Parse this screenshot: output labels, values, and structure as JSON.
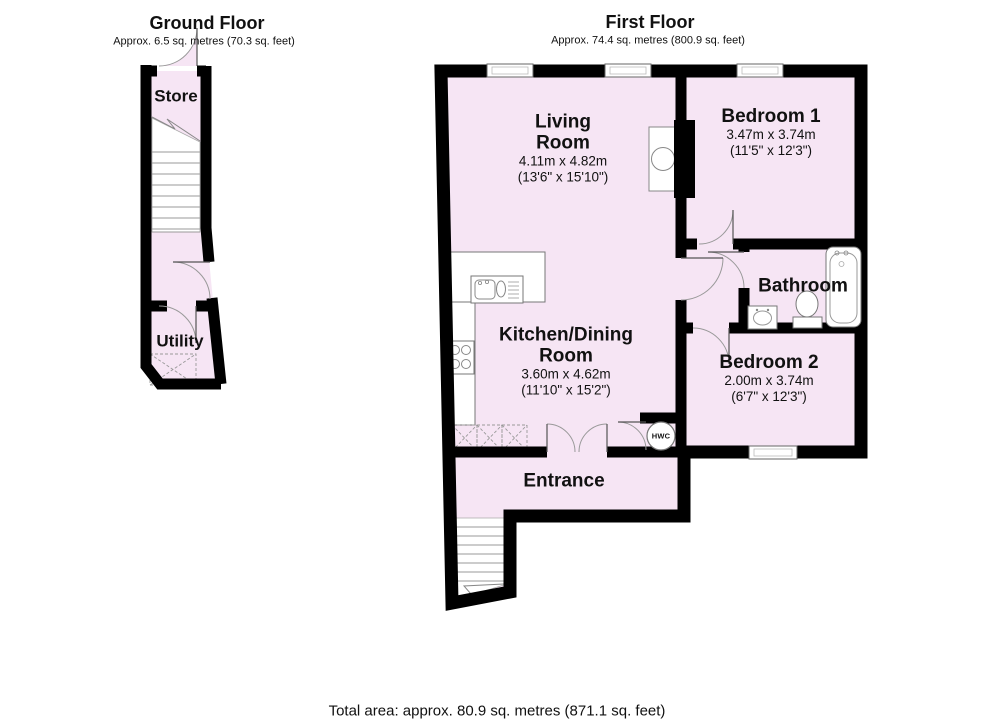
{
  "ground_floor": {
    "title": "Ground Floor",
    "area_label": "Approx. 6.5 sq. metres (70.3 sq. feet)",
    "rooms": {
      "store": {
        "name": "Store"
      },
      "utility": {
        "name": "Utility"
      }
    }
  },
  "first_floor": {
    "title": "First Floor",
    "area_label": "Approx. 74.4 sq. metres (800.9 sq. feet)",
    "rooms": {
      "living_room": {
        "name_line1": "Living",
        "name_line2": "Room",
        "dims_metric": "4.11m x 4.82m",
        "dims_imperial": "(13'6\" x 15'10\")"
      },
      "kitchen_dining": {
        "name_line1": "Kitchen/Dining",
        "name_line2": "Room",
        "dims_metric": "3.60m x 4.62m",
        "dims_imperial": "(11'10\" x 15'2\")"
      },
      "bedroom_1": {
        "name": "Bedroom 1",
        "dims_metric": "3.47m x 3.74m",
        "dims_imperial": "(11'5\" x 12'3\")"
      },
      "bedroom_2": {
        "name": "Bedroom 2",
        "dims_metric": "2.00m x 3.74m",
        "dims_imperial": "(6'7\" x 12'3\")"
      },
      "bathroom": {
        "name": "Bathroom"
      },
      "entrance": {
        "name": "Entrance"
      },
      "hwc": {
        "label": "HWC"
      }
    }
  },
  "footer": {
    "total_area": "Total area: approx. 80.9 sq. metres (871.1 sq. feet)"
  },
  "colors": {
    "room_fill": "#f6e5f4",
    "wall": "#000000",
    "fixture_outline": "#777777"
  }
}
